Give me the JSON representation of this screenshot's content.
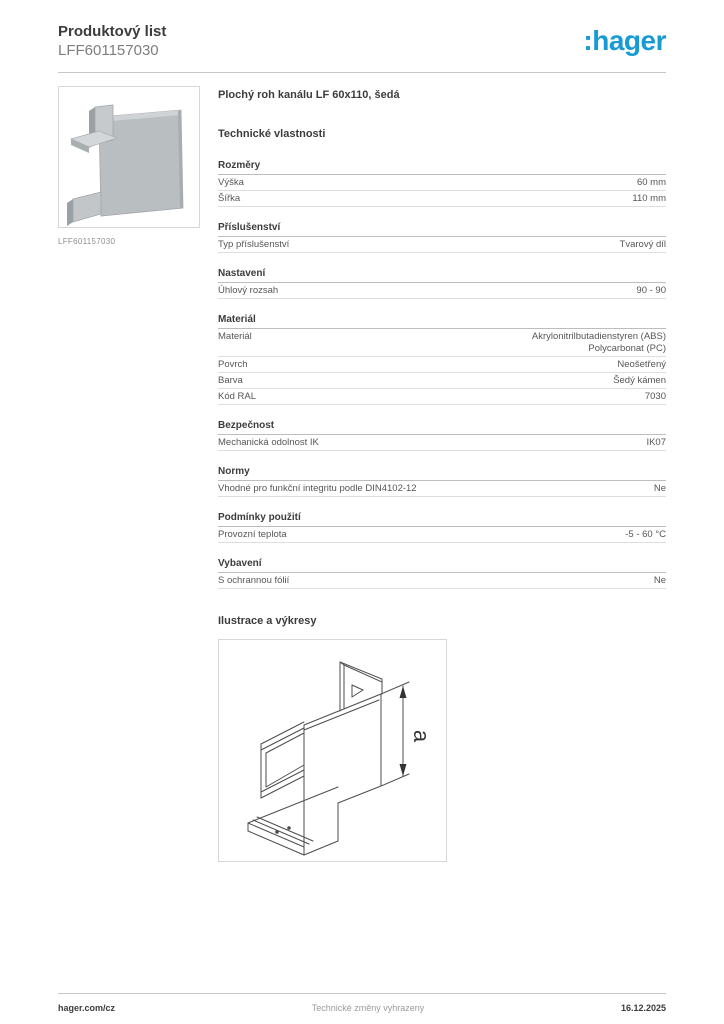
{
  "header": {
    "doc_type": "Produktový list",
    "product_code": "LFF601157030"
  },
  "logo": {
    "text": ":hager",
    "color": "#189bd5"
  },
  "product": {
    "title": "Plochý roh kanálu LF 60x110, šedá",
    "image_caption": "LFF601157030"
  },
  "tech": {
    "heading": "Technické vlastnosti",
    "sections": [
      {
        "title": "Rozměry",
        "rows": [
          {
            "label": "Výška",
            "value": "60 mm"
          },
          {
            "label": "Šířka",
            "value": "110 mm"
          }
        ]
      },
      {
        "title": "Příslušenství",
        "rows": [
          {
            "label": "Typ příslušenství",
            "value": "Tvarový díl"
          }
        ]
      },
      {
        "title": "Nastavení",
        "rows": [
          {
            "label": "Úhlový rozsah",
            "value": "90 - 90"
          }
        ]
      },
      {
        "title": "Materiál",
        "rows": [
          {
            "label": "Materiál",
            "value": "Akrylonitrilbutadienstyren (ABS)\nPolycarbonat (PC)"
          },
          {
            "label": "Povrch",
            "value": "Neošetřený"
          },
          {
            "label": "Barva",
            "value": "Šedý kámen"
          },
          {
            "label": "Kód RAL",
            "value": "7030"
          }
        ]
      },
      {
        "title": "Bezpečnost",
        "rows": [
          {
            "label": "Mechanická odolnost IK",
            "value": "IK07"
          }
        ]
      },
      {
        "title": "Normy",
        "rows": [
          {
            "label": "Vhodné pro funkční integritu podle DIN4102-12",
            "value": "Ne"
          }
        ]
      },
      {
        "title": "Podmínky použití",
        "rows": [
          {
            "label": "Provozní teplota",
            "value": "-5 - 60 °C"
          }
        ]
      },
      {
        "title": "Vybavení",
        "rows": [
          {
            "label": "S ochrannou fólií",
            "value": "Ne"
          }
        ]
      }
    ]
  },
  "illustration": {
    "heading": "Ilustrace a výkresy",
    "dimension_label": "a"
  },
  "footer": {
    "left": "hager.com/cz",
    "center": "Technické změny vyhrazeny",
    "right": "16.12.2025"
  }
}
